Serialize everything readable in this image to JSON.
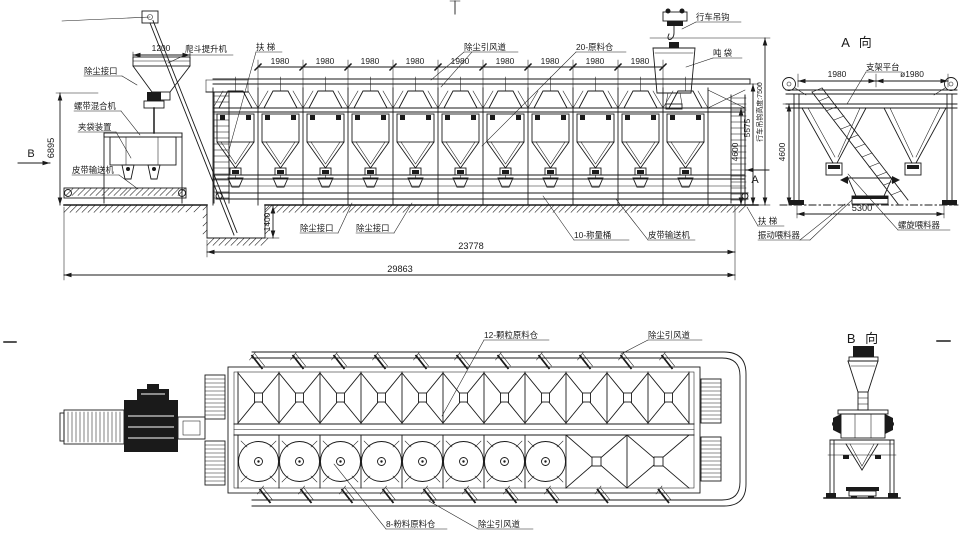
{
  "colors": {
    "ink": "#1a1a1a",
    "paper": "#ffffff"
  },
  "labels": {
    "bucket_elevator": "爬斗提升机",
    "dust_port": "除尘接口",
    "ribbon_mixer": "螺带混合机",
    "bag_clamp": "夹袋装置",
    "belt_conveyor": "皮带输送机",
    "ladder": "扶 梯",
    "dust_duct": "除尘引风道",
    "silos_20": "20-原料仓",
    "crane_hook": "行车吊钩",
    "ton_bag": "吨 袋",
    "view_a": "A 向",
    "view_b": "B 向",
    "support_platform": "支架平台",
    "weigh_bins": "10-称量桶",
    "vibrating_feeder": "振动喂料器",
    "screw_feeder": "螺旋喂料器",
    "granular_silos": "12-颗粒原料仓",
    "powder_silos": "8-粉料原料仓",
    "section_a": "A",
    "section_b": "B"
  },
  "dims": {
    "d1200": "1200",
    "d1980": "1980",
    "dia1980": "ø1980",
    "d6895": "6895",
    "crane_height": "行车吊钩高度:7500",
    "d5575": "5575",
    "d4600": "4600",
    "d1400": "1400",
    "d5300": "5300",
    "d23778": "23778",
    "d29863": "29863"
  }
}
